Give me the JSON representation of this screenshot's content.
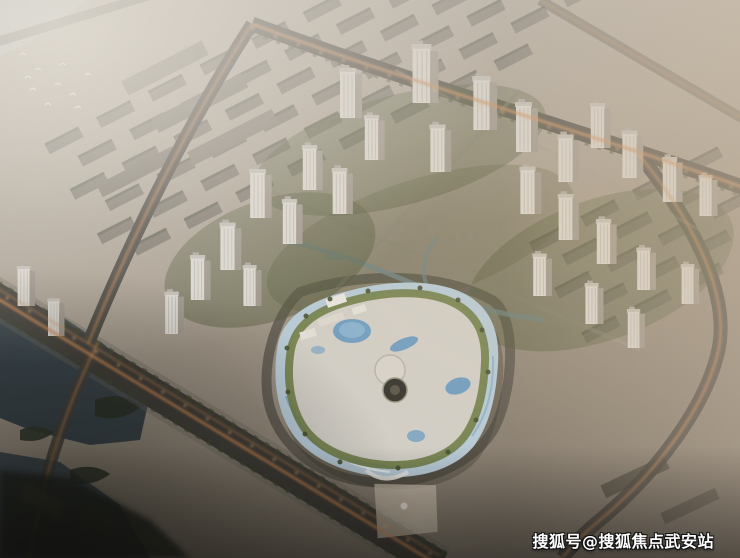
{
  "scene": {
    "kind": "aerial-architectural-rendering",
    "alt": "Hazy dusk aerial rendering of a master-planned community: clusters of white residential high-rise towers, a curved blue-and-white shopping mall with rooftop pools and green roof gardens, diagonal boulevards with warm street-light glow, a dark lake and river at left, and faded older city blocks in the background"
  },
  "watermark": {
    "text": "搜狐号@搜狐焦点武安站",
    "color": "#ffffff",
    "outline_color": "#111111"
  },
  "palette": {
    "haze": "#c9c2b6",
    "road": "#413e39",
    "road_glow": "#cf8a52",
    "streetlight": "#f0bd7d",
    "water_lake": "#39444b",
    "water_river": "#b7c2c6",
    "canal": "#7d98a2",
    "tower_light": "#dcd9d3",
    "tower_shade": "#9b948a",
    "greenery": "#4b5434",
    "mall_facade_blue": "#b7cbd8",
    "mall_roof_pavement": "#d2cfc8",
    "pool_blue": "#6f9ec2",
    "green_roof": "#6e7c46"
  }
}
